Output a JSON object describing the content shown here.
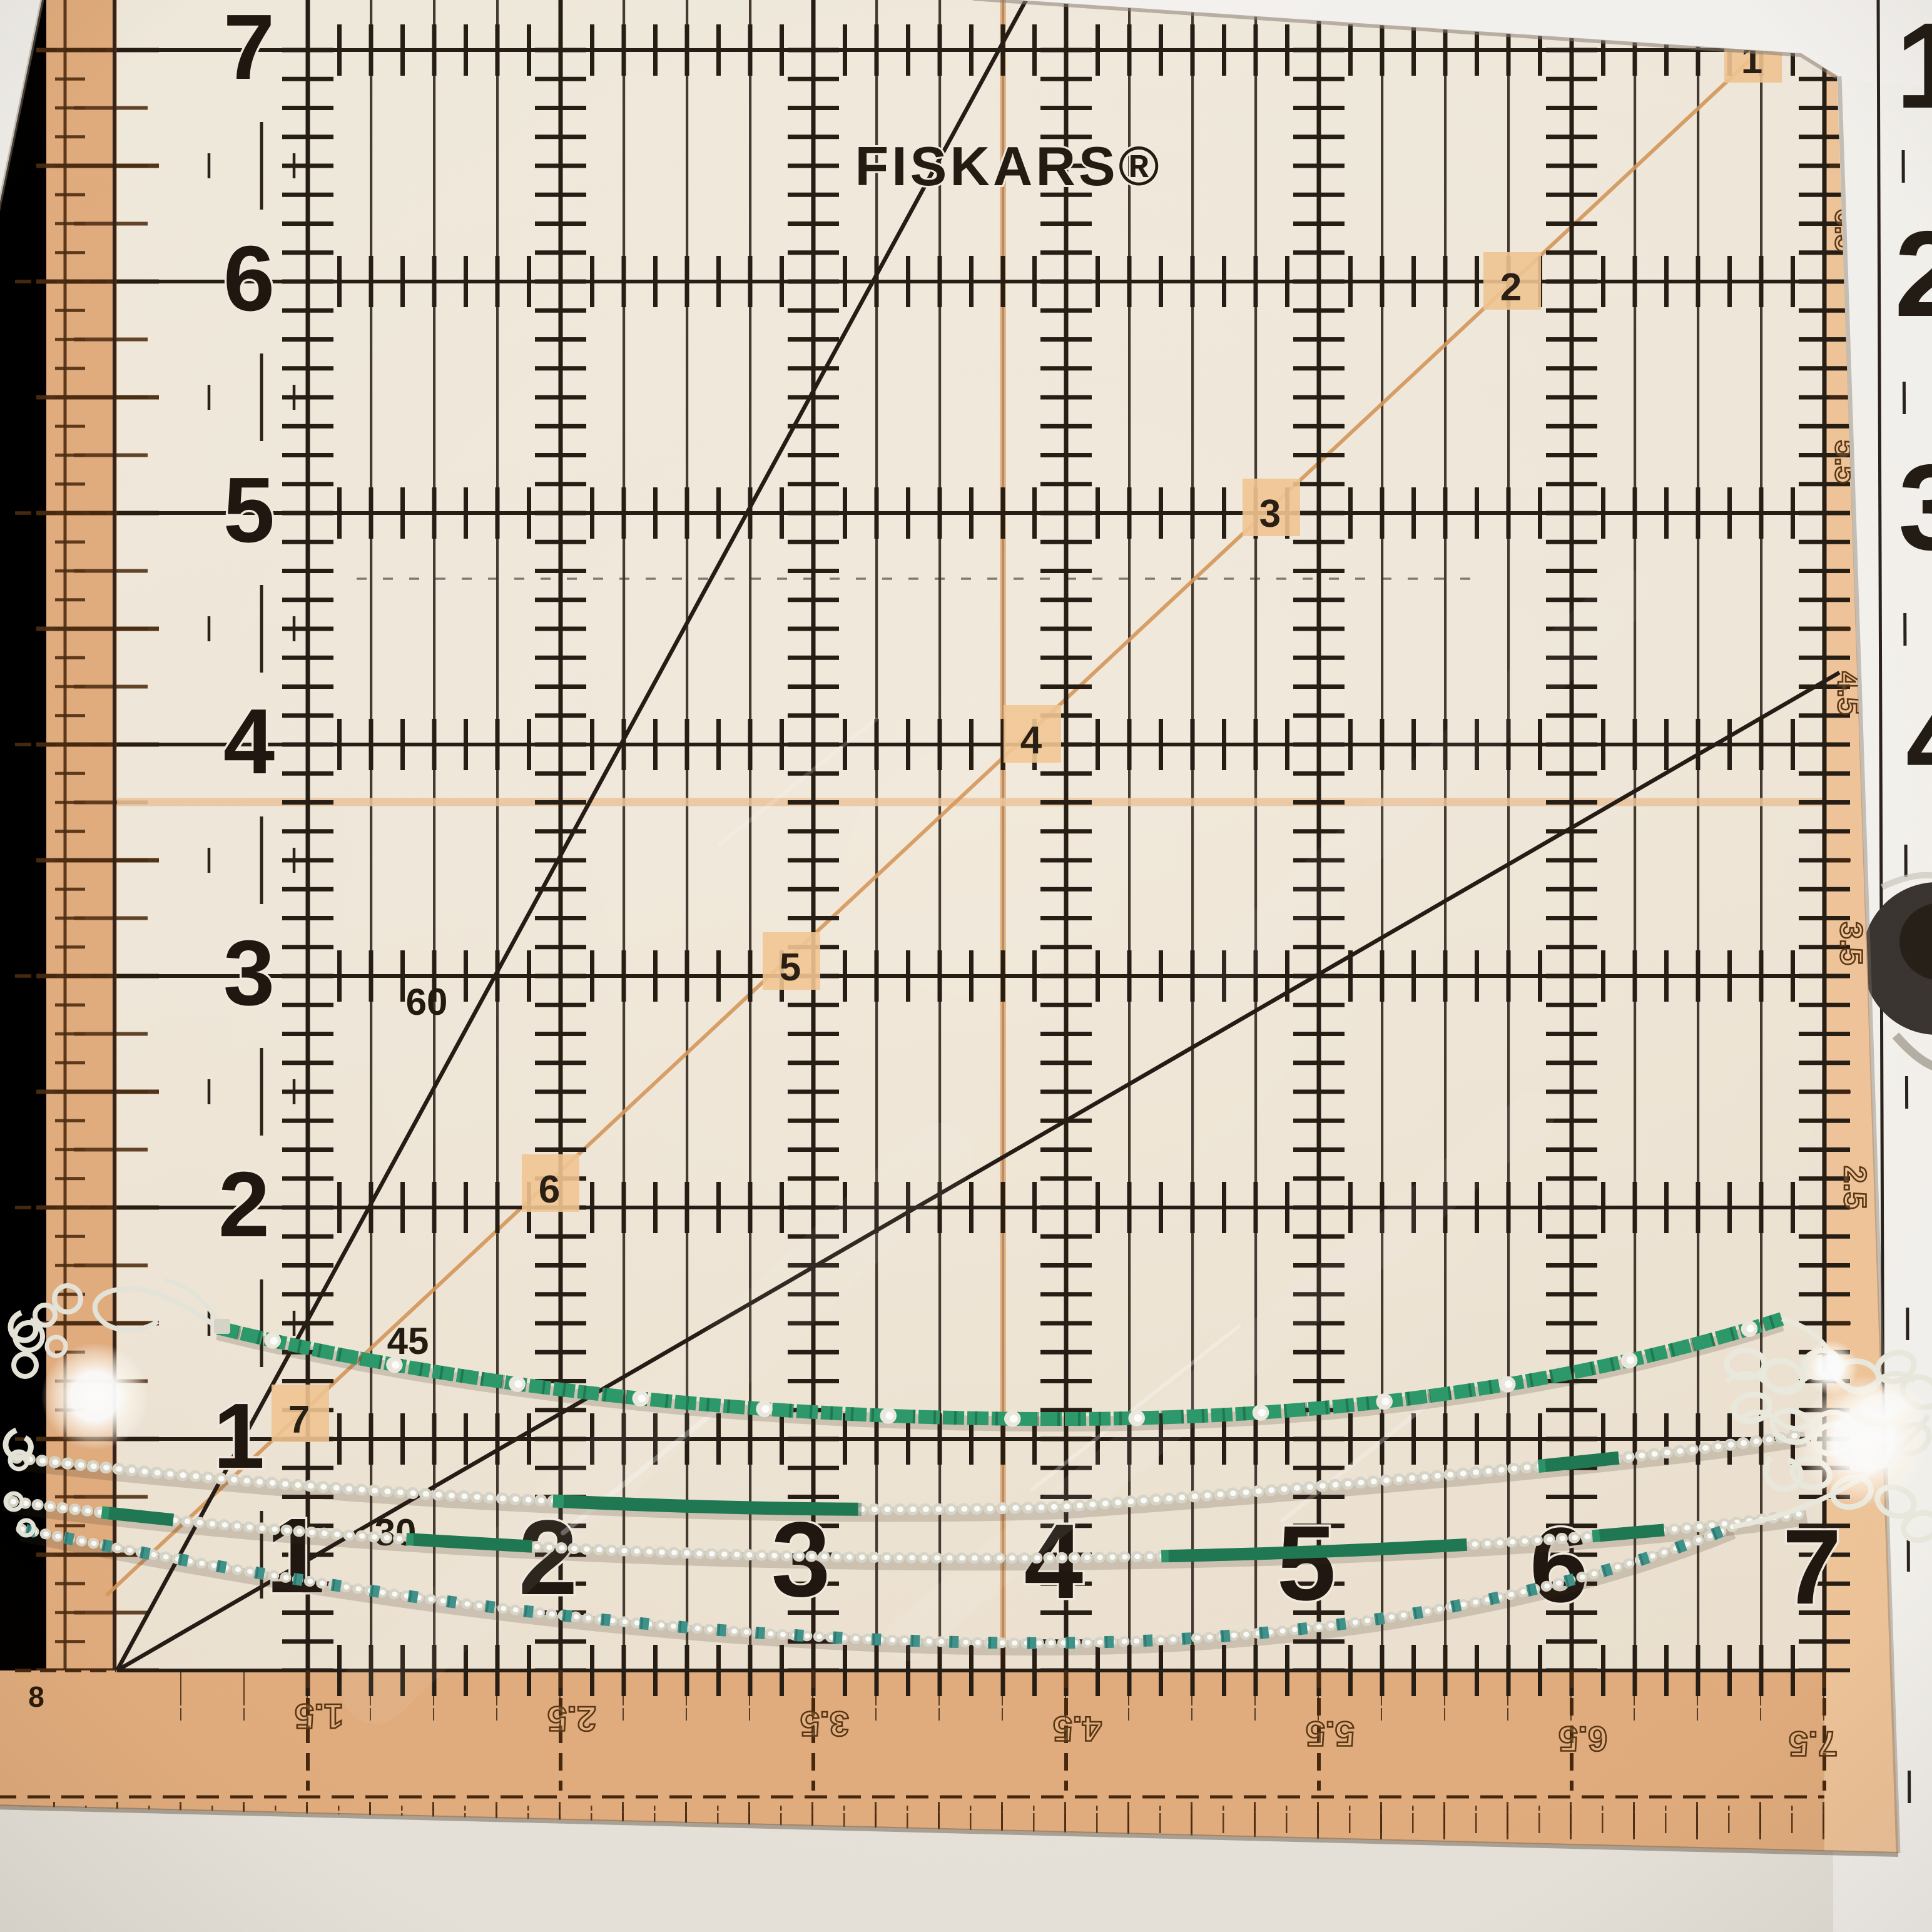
{
  "ruler": {
    "brand": "FISKARS®",
    "left_numbers": [
      "7",
      "6",
      "5",
      "4",
      "3",
      "2",
      "1"
    ],
    "bottom_numbers": [
      "1",
      "2",
      "3",
      "4",
      "5",
      "6",
      "7"
    ],
    "diagonal_numbers": [
      "1",
      "2",
      "3",
      "4",
      "5",
      "6",
      "7"
    ],
    "angle_labels": {
      "sixty": "60",
      "fortyfive": "45",
      "thirty": "30"
    },
    "corner_label": "8",
    "bottom_edge_labels": [
      "1.5",
      "2.5",
      "3.5",
      "4.5",
      "5.5",
      "6.5",
      "7.5"
    ],
    "right_edge_labels": [
      "7.5",
      "6.5",
      "5.5",
      "4.5",
      "3.5",
      "2.5"
    ],
    "side_ruler_numbers": [
      "1",
      "2",
      "3",
      "4"
    ],
    "colors": {
      "ruler_body": "#f1e9db",
      "border_orange": "#e3ae7f",
      "peach_column": "#f1c69b",
      "grid_line": "#2b2219",
      "accent_orange_line": "#e2a873",
      "bead_green": "#2d9a6b",
      "bead_teal": "#3f948b",
      "bead_silver": "#e6e4d8",
      "background": "#f2f0ec"
    }
  }
}
